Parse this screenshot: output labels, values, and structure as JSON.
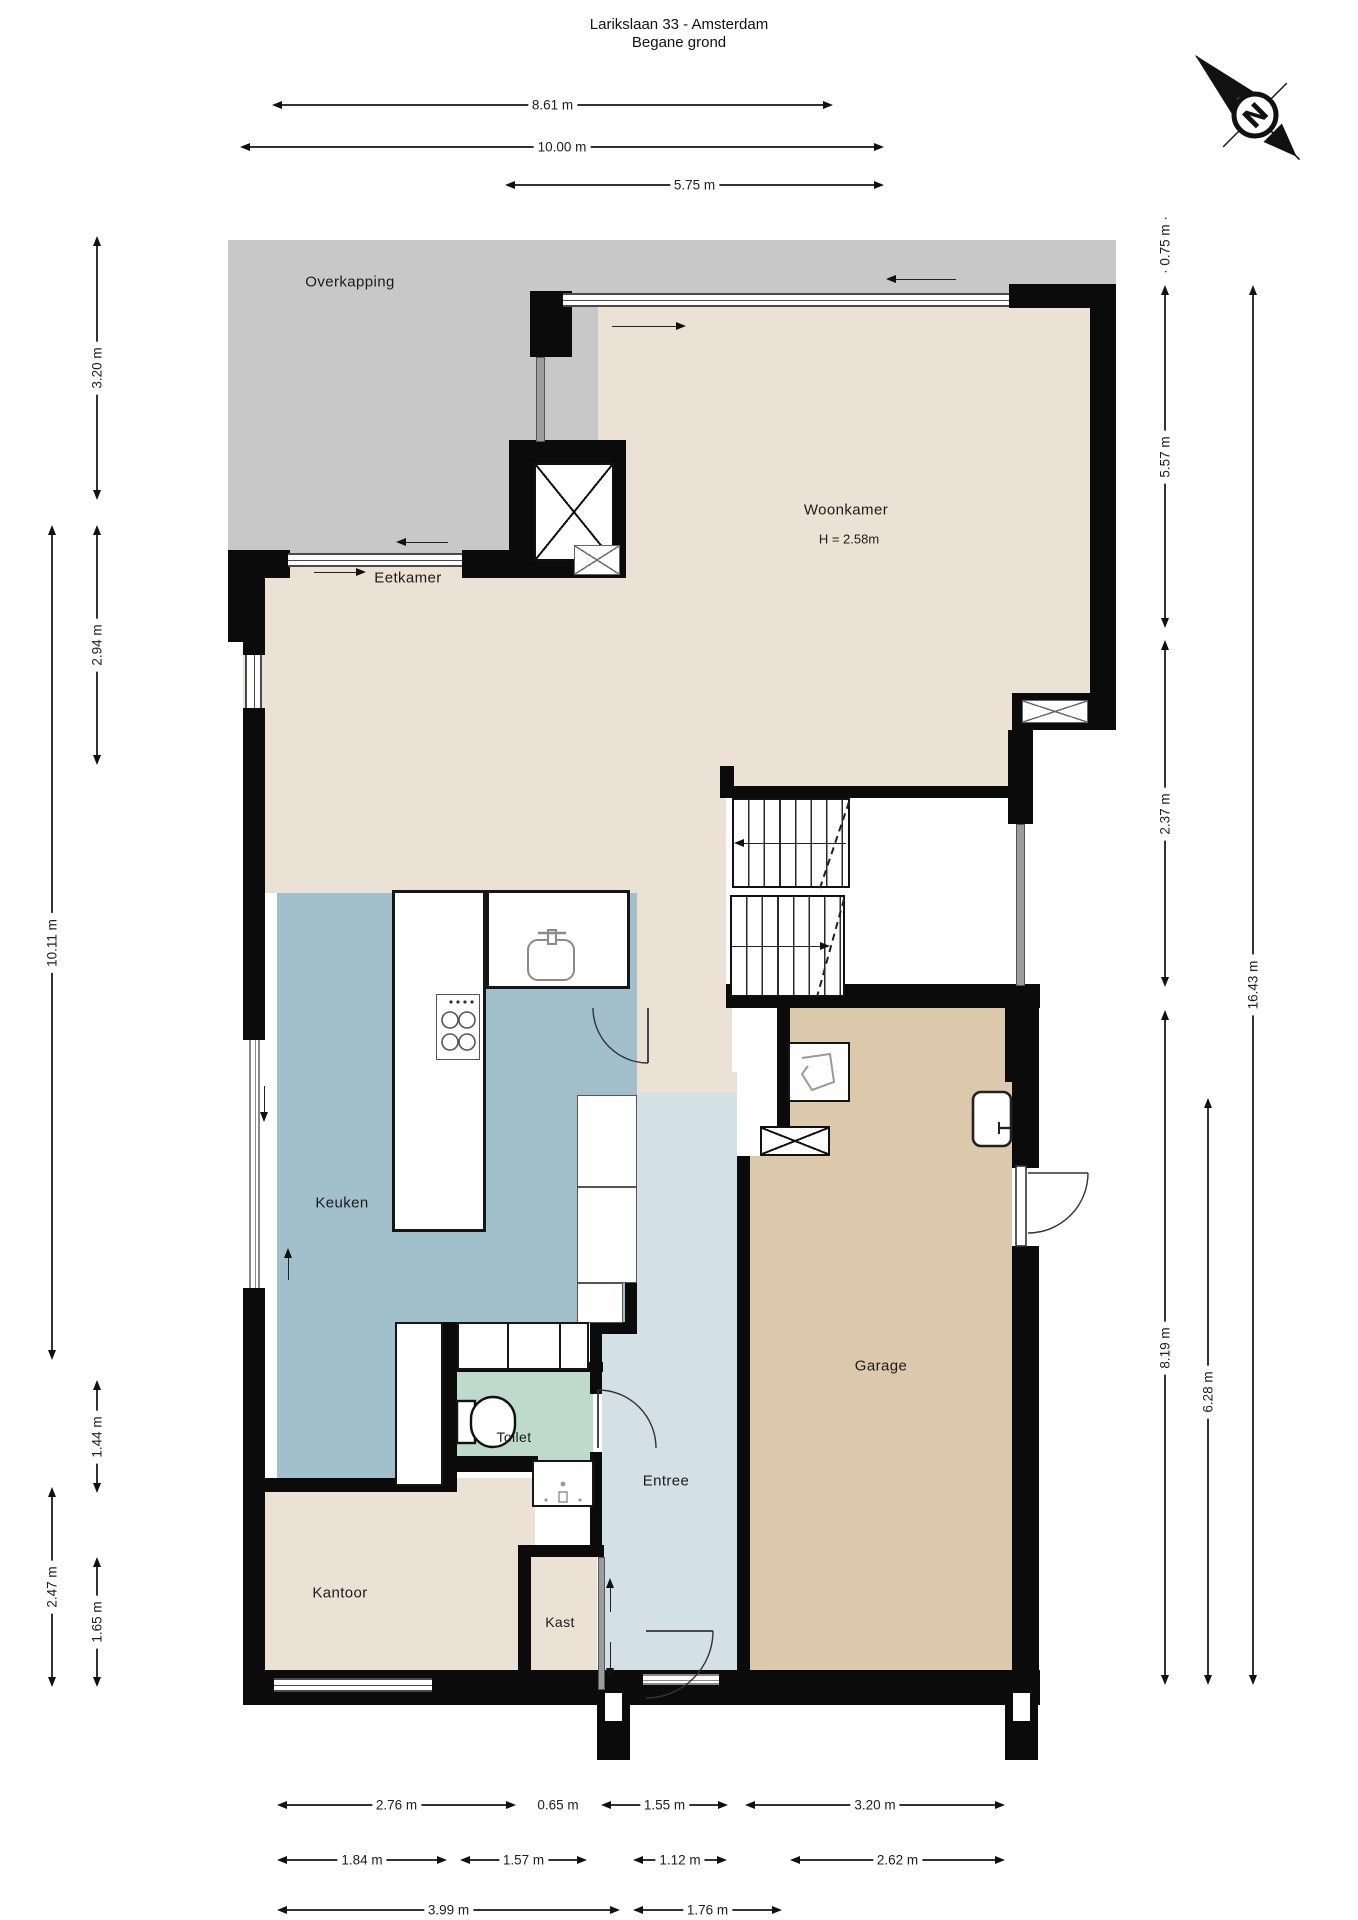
{
  "title": {
    "line1": "Larikslaan 33 - Amsterdam",
    "line2": "Begane grond"
  },
  "compass": {
    "label": "N"
  },
  "rooms": {
    "overkapping": {
      "label": "Overkapping"
    },
    "woonkamer": {
      "label": "Woonkamer",
      "height_note": "H = 2.58m"
    },
    "eetkamer": {
      "label": "Eetkamer"
    },
    "keuken": {
      "label": "Keuken"
    },
    "toilet": {
      "label": "Toilet"
    },
    "entree": {
      "label": "Entree"
    },
    "kast": {
      "label": "Kast"
    },
    "kantoor": {
      "label": "Kantoor"
    },
    "garage": {
      "label": "Garage"
    }
  },
  "colors": {
    "wall": "#0b0b0b",
    "floor_beige": "#ebe2d5",
    "overkapping_gray": "#c8c8c8",
    "keuken_blue": "#a2c0cb",
    "entree_blue": "#d3e1e6",
    "toilet_green": "#bedacb",
    "garage_tan": "#dcc9ac",
    "dimension": "#1d1d1d"
  },
  "dimensions": {
    "top": [
      {
        "label": "8.61 m",
        "x1": 272,
        "x2": 833,
        "y": 105
      },
      {
        "label": "10.00 m",
        "x1": 240,
        "x2": 884,
        "y": 147
      },
      {
        "label": "5.75 m",
        "x1": 505,
        "x2": 884,
        "y": 185
      }
    ],
    "left": [
      {
        "label": "3.20 m",
        "x": 97,
        "y1": 236,
        "y2": 500
      },
      {
        "label": "2.94 m",
        "x": 97,
        "y1": 525,
        "y2": 765
      },
      {
        "label": "10.11 m",
        "x": 52,
        "y1": 525,
        "y2": 1360
      },
      {
        "label": "1.44 m",
        "x": 97,
        "y1": 1380,
        "y2": 1493
      },
      {
        "label": "2.47 m",
        "x": 52,
        "y1": 1487,
        "y2": 1687
      },
      {
        "label": "1.65 m",
        "x": 97,
        "y1": 1557,
        "y2": 1687
      }
    ],
    "right": [
      {
        "label": "5.57 m",
        "x": 1165,
        "y1": 285,
        "y2": 628
      },
      {
        "label": "2.37 m",
        "x": 1165,
        "y1": 640,
        "y2": 987
      },
      {
        "label": "8.19 m",
        "x": 1165,
        "y1": 1010,
        "y2": 1685
      },
      {
        "label": "6.28 m",
        "x": 1208,
        "y1": 1098,
        "y2": 1685
      },
      {
        "label": "16.43 m",
        "x": 1253,
        "y1": 285,
        "y2": 1685
      }
    ],
    "bottom": [
      {
        "label": "2.76 m",
        "x1": 277,
        "x2": 516,
        "y": 1805
      },
      {
        "label": "1.55 m",
        "x1": 601,
        "x2": 728,
        "y": 1805
      },
      {
        "label": "3.20 m",
        "x1": 745,
        "x2": 1005,
        "y": 1805
      },
      {
        "label": "1.84 m",
        "x1": 277,
        "x2": 447,
        "y": 1860
      },
      {
        "label": "1.57 m",
        "x1": 460,
        "x2": 587,
        "y": 1860
      },
      {
        "label": "1.12 m",
        "x1": 633,
        "x2": 727,
        "y": 1860
      },
      {
        "label": "2.62 m",
        "x1": 790,
        "x2": 1005,
        "y": 1860
      },
      {
        "label": "3.99 m",
        "x1": 277,
        "x2": 620,
        "y": 1910
      },
      {
        "label": "1.76 m",
        "x1": 633,
        "x2": 782,
        "y": 1910
      }
    ],
    "plain": [
      {
        "label": "0.65 m",
        "x": 558,
        "y": 1805,
        "orient": "h"
      },
      {
        "label": "· 0.75 m ·",
        "x": 1165,
        "y": 245,
        "orient": "v"
      }
    ]
  }
}
